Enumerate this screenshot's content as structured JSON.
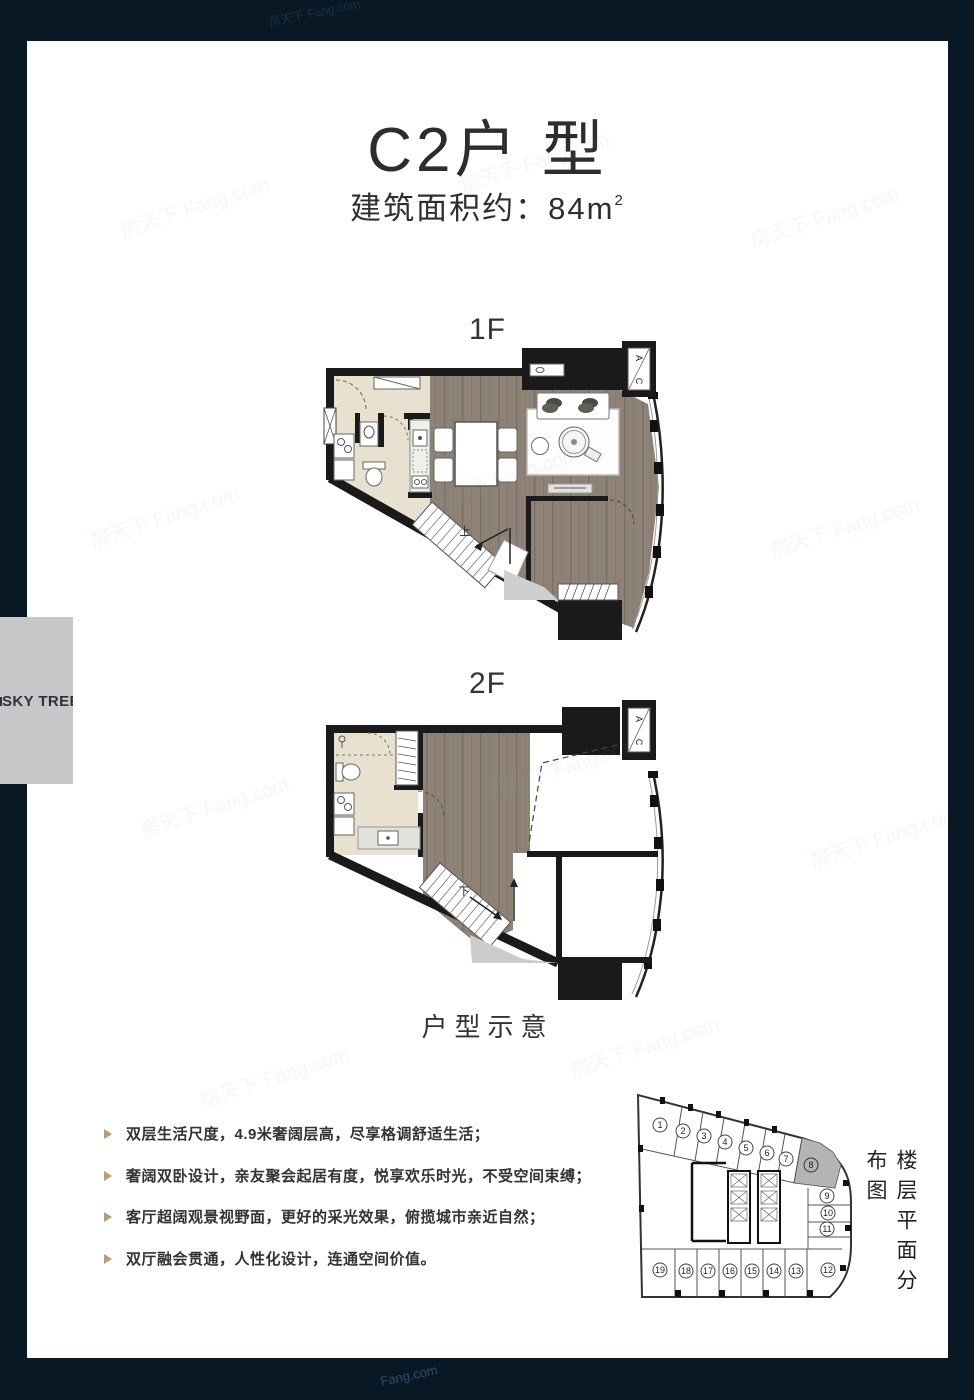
{
  "page": {
    "title": "C2户 型",
    "subtitle": {
      "text": "建筑面积约：84m",
      "sup": "2"
    },
    "watermark": "房天下 Fang.com",
    "watermark_bottom": "Fang.com"
  },
  "logo": {
    "text": "SKY TREE"
  },
  "plans": {
    "caption": "户型示意",
    "floor1": {
      "label": "1F",
      "ac_a": "A",
      "ac_c": "C",
      "stair": "上"
    },
    "floor2": {
      "label": "2F",
      "ac_a": "A",
      "ac_c": "C",
      "stair": "下"
    }
  },
  "features": {
    "items": [
      "双层生活尺度，4.9米奢阔层高，尽享格调舒适生活；",
      "奢阔双卧设计，亲友聚会起居有度，悦享欢乐时光，不受空间束缚；",
      "客厅超阔观景视野面，更好的采光效果，俯揽城市亲近自然；",
      "双厅融会贯通，人性化设计，连通空间价值。"
    ]
  },
  "distribution": {
    "title": "楼层平面分布图",
    "highlighted_unit": "8",
    "units": [
      "1",
      "2",
      "3",
      "4",
      "5",
      "6",
      "7",
      "8",
      "9",
      "10",
      "11",
      "12",
      "13",
      "14",
      "15",
      "16",
      "17",
      "18",
      "19"
    ]
  },
  "colors": {
    "border_navy": "#081825",
    "wall_black": "#1a1a1a",
    "wood_floor": "#8e8277",
    "tile_beige": "#e9e1cf",
    "counter_gray": "#dfe3dc",
    "logo_bg": "#c6c7c9",
    "bullet_tan": "#b59d77",
    "highlight_gray": "#b4b4b4"
  }
}
